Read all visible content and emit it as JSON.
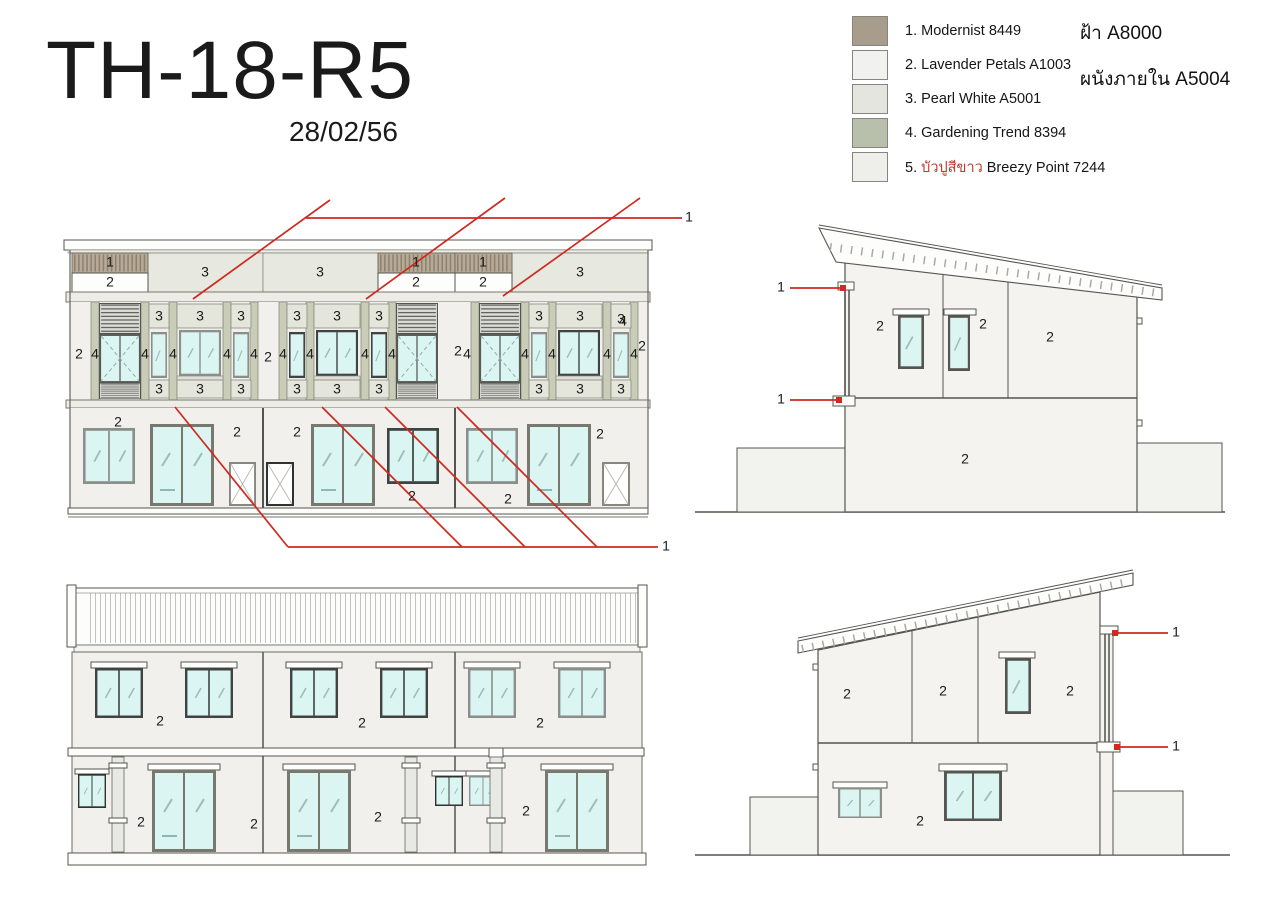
{
  "page": {
    "sheet_code": "TH-18-R5",
    "sheet_date": "28/02/56"
  },
  "notes": {
    "ceiling": "ฝ้า A8000",
    "interior_wall": "ผนังภายใน A5004"
  },
  "colors": {
    "accent_red": "#c4372a",
    "leader_red": "#cf2a20"
  },
  "legend": [
    {
      "pre": "1. ",
      "thai": "",
      "post": "Modernist 8449",
      "color": "#a89d8d"
    },
    {
      "pre": "2. ",
      "thai": "",
      "post": "Lavender Petals A1003",
      "color": "#f1f1ef"
    },
    {
      "pre": "3. ",
      "thai": "",
      "post": "Pearl White A5001",
      "color": "#e5e5df"
    },
    {
      "pre": "4. ",
      "thai": "",
      "post": "Gardening Trend  8394",
      "color": "#b8bfaa"
    },
    {
      "pre": "5. ",
      "thai": "บัวปูสีขาว",
      "post": " Breezy Point 7244",
      "color": "#eeeeeb"
    }
  ],
  "drawings": {
    "front": {
      "labels": [
        {
          "t": "1",
          "x": 110,
          "y": 263
        },
        {
          "t": "2",
          "x": 110,
          "y": 283
        },
        {
          "t": "3",
          "x": 205,
          "y": 273
        },
        {
          "t": "3",
          "x": 320,
          "y": 273
        },
        {
          "t": "1",
          "x": 416,
          "y": 263
        },
        {
          "t": "2",
          "x": 416,
          "y": 283
        },
        {
          "t": "1",
          "x": 483,
          "y": 263
        },
        {
          "t": "2",
          "x": 483,
          "y": 283
        },
        {
          "t": "3",
          "x": 580,
          "y": 273
        },
        {
          "t": "3",
          "x": 159,
          "y": 317
        },
        {
          "t": "3",
          "x": 200,
          "y": 317
        },
        {
          "t": "3",
          "x": 241,
          "y": 317
        },
        {
          "t": "3",
          "x": 297,
          "y": 317
        },
        {
          "t": "3",
          "x": 337,
          "y": 317
        },
        {
          "t": "3",
          "x": 379,
          "y": 317
        },
        {
          "t": "3",
          "x": 539,
          "y": 317
        },
        {
          "t": "3",
          "x": 580,
          "y": 317
        },
        {
          "t": "3",
          "x": 621,
          "y": 320
        },
        {
          "t": "3",
          "x": 159,
          "y": 390
        },
        {
          "t": "3",
          "x": 200,
          "y": 390
        },
        {
          "t": "3",
          "x": 241,
          "y": 390
        },
        {
          "t": "3",
          "x": 297,
          "y": 390
        },
        {
          "t": "3",
          "x": 337,
          "y": 390
        },
        {
          "t": "3",
          "x": 379,
          "y": 390
        },
        {
          "t": "3",
          "x": 539,
          "y": 390
        },
        {
          "t": "3",
          "x": 580,
          "y": 390
        },
        {
          "t": "3",
          "x": 621,
          "y": 390
        },
        {
          "t": "4",
          "x": 95,
          "y": 355
        },
        {
          "t": "4",
          "x": 145,
          "y": 355
        },
        {
          "t": "4",
          "x": 173,
          "y": 355
        },
        {
          "t": "4",
          "x": 227,
          "y": 355
        },
        {
          "t": "4",
          "x": 254,
          "y": 355
        },
        {
          "t": "4",
          "x": 283,
          "y": 355
        },
        {
          "t": "4",
          "x": 310,
          "y": 355
        },
        {
          "t": "4",
          "x": 365,
          "y": 355
        },
        {
          "t": "4",
          "x": 392,
          "y": 355
        },
        {
          "t": "4",
          "x": 467,
          "y": 355
        },
        {
          "t": "4",
          "x": 525,
          "y": 355
        },
        {
          "t": "4",
          "x": 552,
          "y": 355
        },
        {
          "t": "4",
          "x": 607,
          "y": 355
        },
        {
          "t": "4",
          "x": 634,
          "y": 355
        },
        {
          "t": "4",
          "x": 623,
          "y": 322
        },
        {
          "t": "2",
          "x": 79,
          "y": 355
        },
        {
          "t": "2",
          "x": 268,
          "y": 358
        },
        {
          "t": "2",
          "x": 458,
          "y": 352
        },
        {
          "t": "2",
          "x": 642,
          "y": 347
        },
        {
          "t": "2",
          "x": 118,
          "y": 423
        },
        {
          "t": "2",
          "x": 237,
          "y": 433
        },
        {
          "t": "2",
          "x": 297,
          "y": 433
        },
        {
          "t": "2",
          "x": 412,
          "y": 497
        },
        {
          "t": "2",
          "x": 600,
          "y": 435
        },
        {
          "t": "2",
          "x": 508,
          "y": 500
        },
        {
          "t": "1",
          "x": 689,
          "y": 218
        },
        {
          "t": "1",
          "x": 666,
          "y": 547
        }
      ]
    },
    "rear": {
      "labels": [
        {
          "t": "2",
          "x": 160,
          "y": 722
        },
        {
          "t": "2",
          "x": 362,
          "y": 724
        },
        {
          "t": "2",
          "x": 540,
          "y": 724
        },
        {
          "t": "2",
          "x": 141,
          "y": 823
        },
        {
          "t": "2",
          "x": 254,
          "y": 825
        },
        {
          "t": "2",
          "x": 378,
          "y": 818
        },
        {
          "t": "2",
          "x": 526,
          "y": 812
        }
      ]
    },
    "side_right": {
      "labels": [
        {
          "t": "2",
          "x": 880,
          "y": 327
        },
        {
          "t": "2",
          "x": 983,
          "y": 325
        },
        {
          "t": "2",
          "x": 1050,
          "y": 338
        },
        {
          "t": "2",
          "x": 965,
          "y": 460
        },
        {
          "t": "1",
          "x": 781,
          "y": 288
        },
        {
          "t": "1",
          "x": 781,
          "y": 400
        }
      ]
    },
    "side_left": {
      "labels": [
        {
          "t": "2",
          "x": 847,
          "y": 695
        },
        {
          "t": "2",
          "x": 943,
          "y": 692
        },
        {
          "t": "2",
          "x": 1070,
          "y": 692
        },
        {
          "t": "2",
          "x": 920,
          "y": 822
        },
        {
          "t": "1",
          "x": 1176,
          "y": 633
        },
        {
          "t": "1",
          "x": 1176,
          "y": 747
        }
      ]
    }
  }
}
